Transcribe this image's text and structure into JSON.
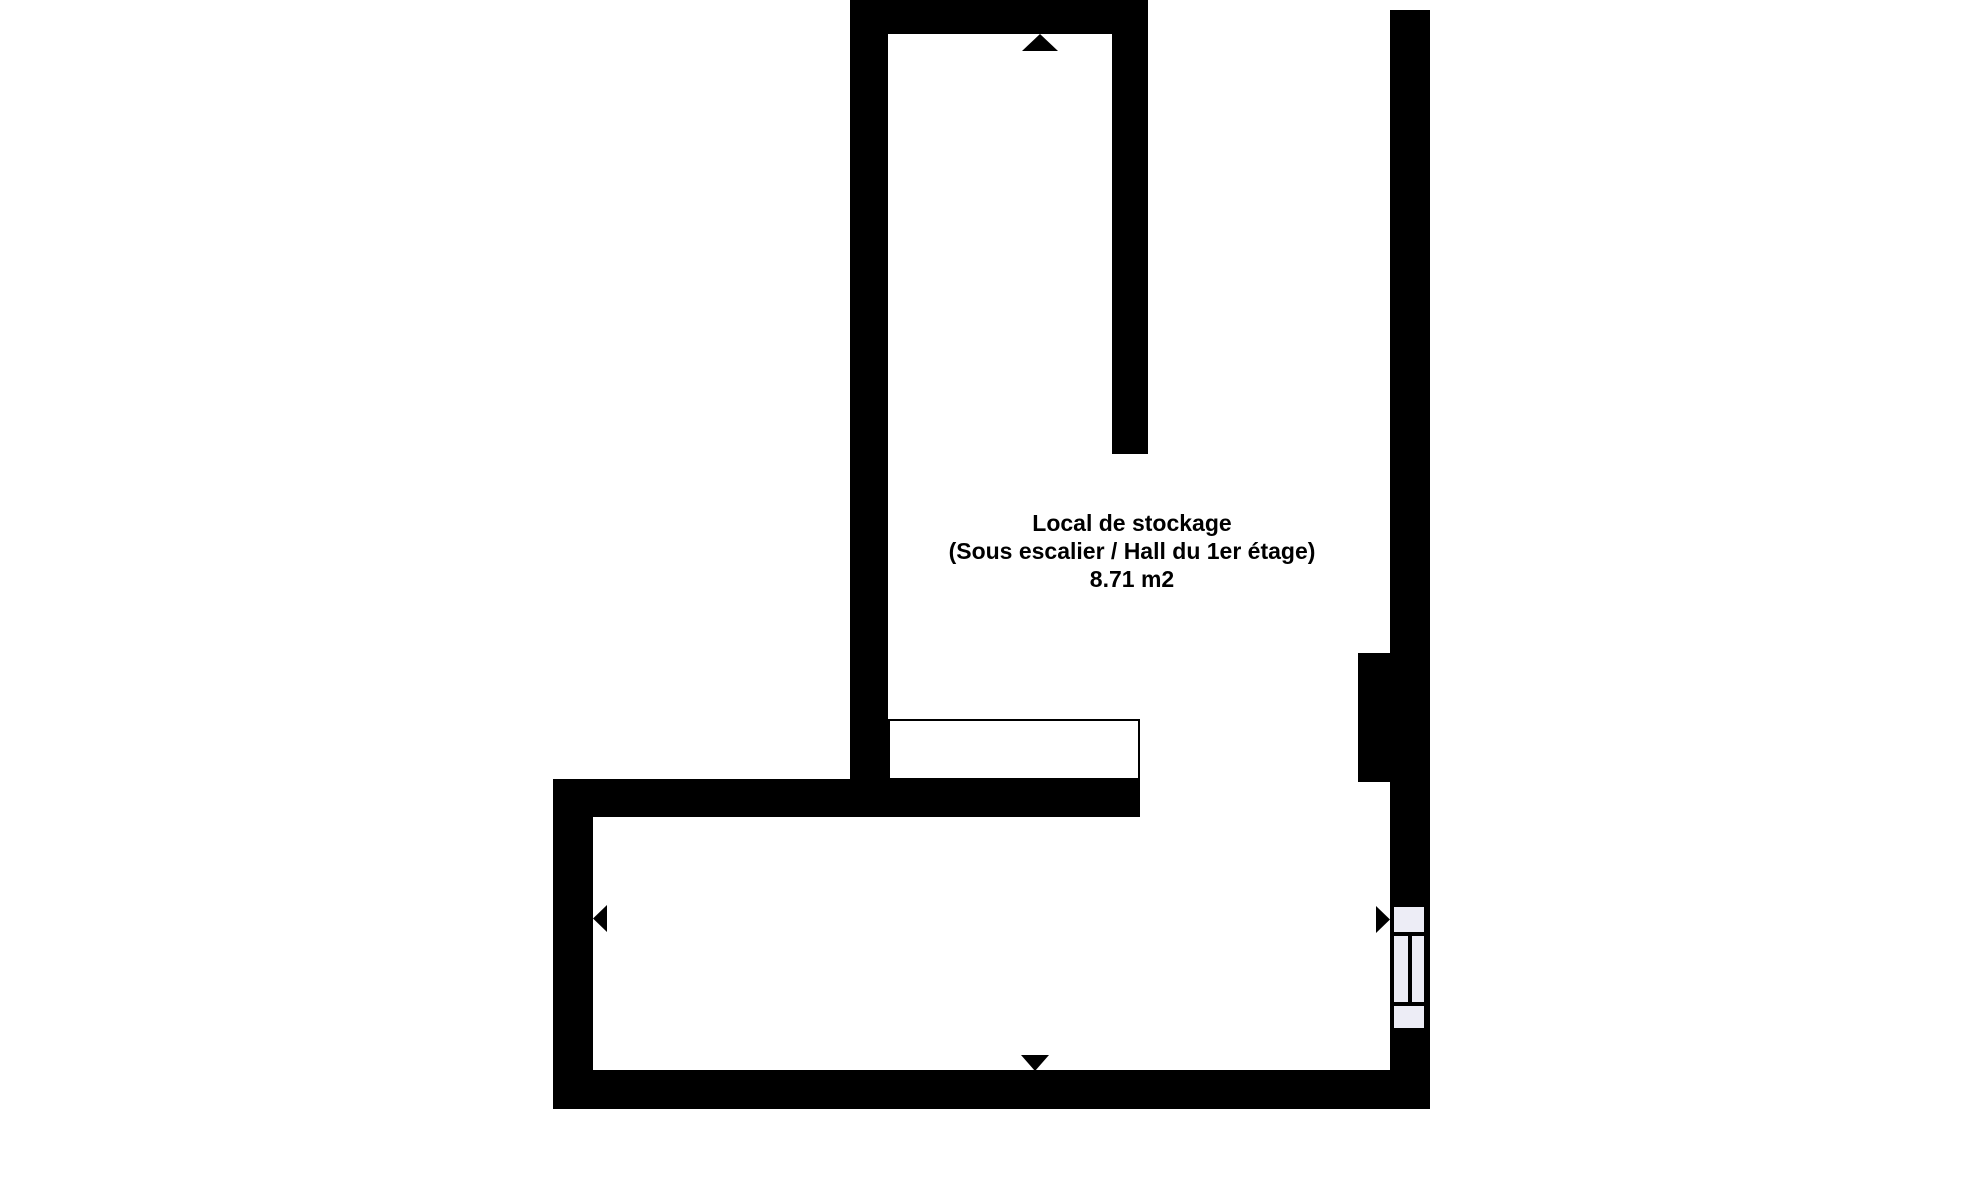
{
  "colors": {
    "background": "#ffffff",
    "wall": "#000000",
    "fixture_fill": "#ededf6",
    "label": "#000000"
  },
  "floorplan": {
    "room_label": {
      "name": "Local de stockage",
      "location": "(Sous escalier / Hall du 1er étage)",
      "area": "8.71 m2"
    },
    "icons": {
      "marker_up": "triangle-up",
      "marker_down": "triangle-down",
      "marker_left": "triangle-left",
      "marker_right": "triangle-right"
    }
  }
}
